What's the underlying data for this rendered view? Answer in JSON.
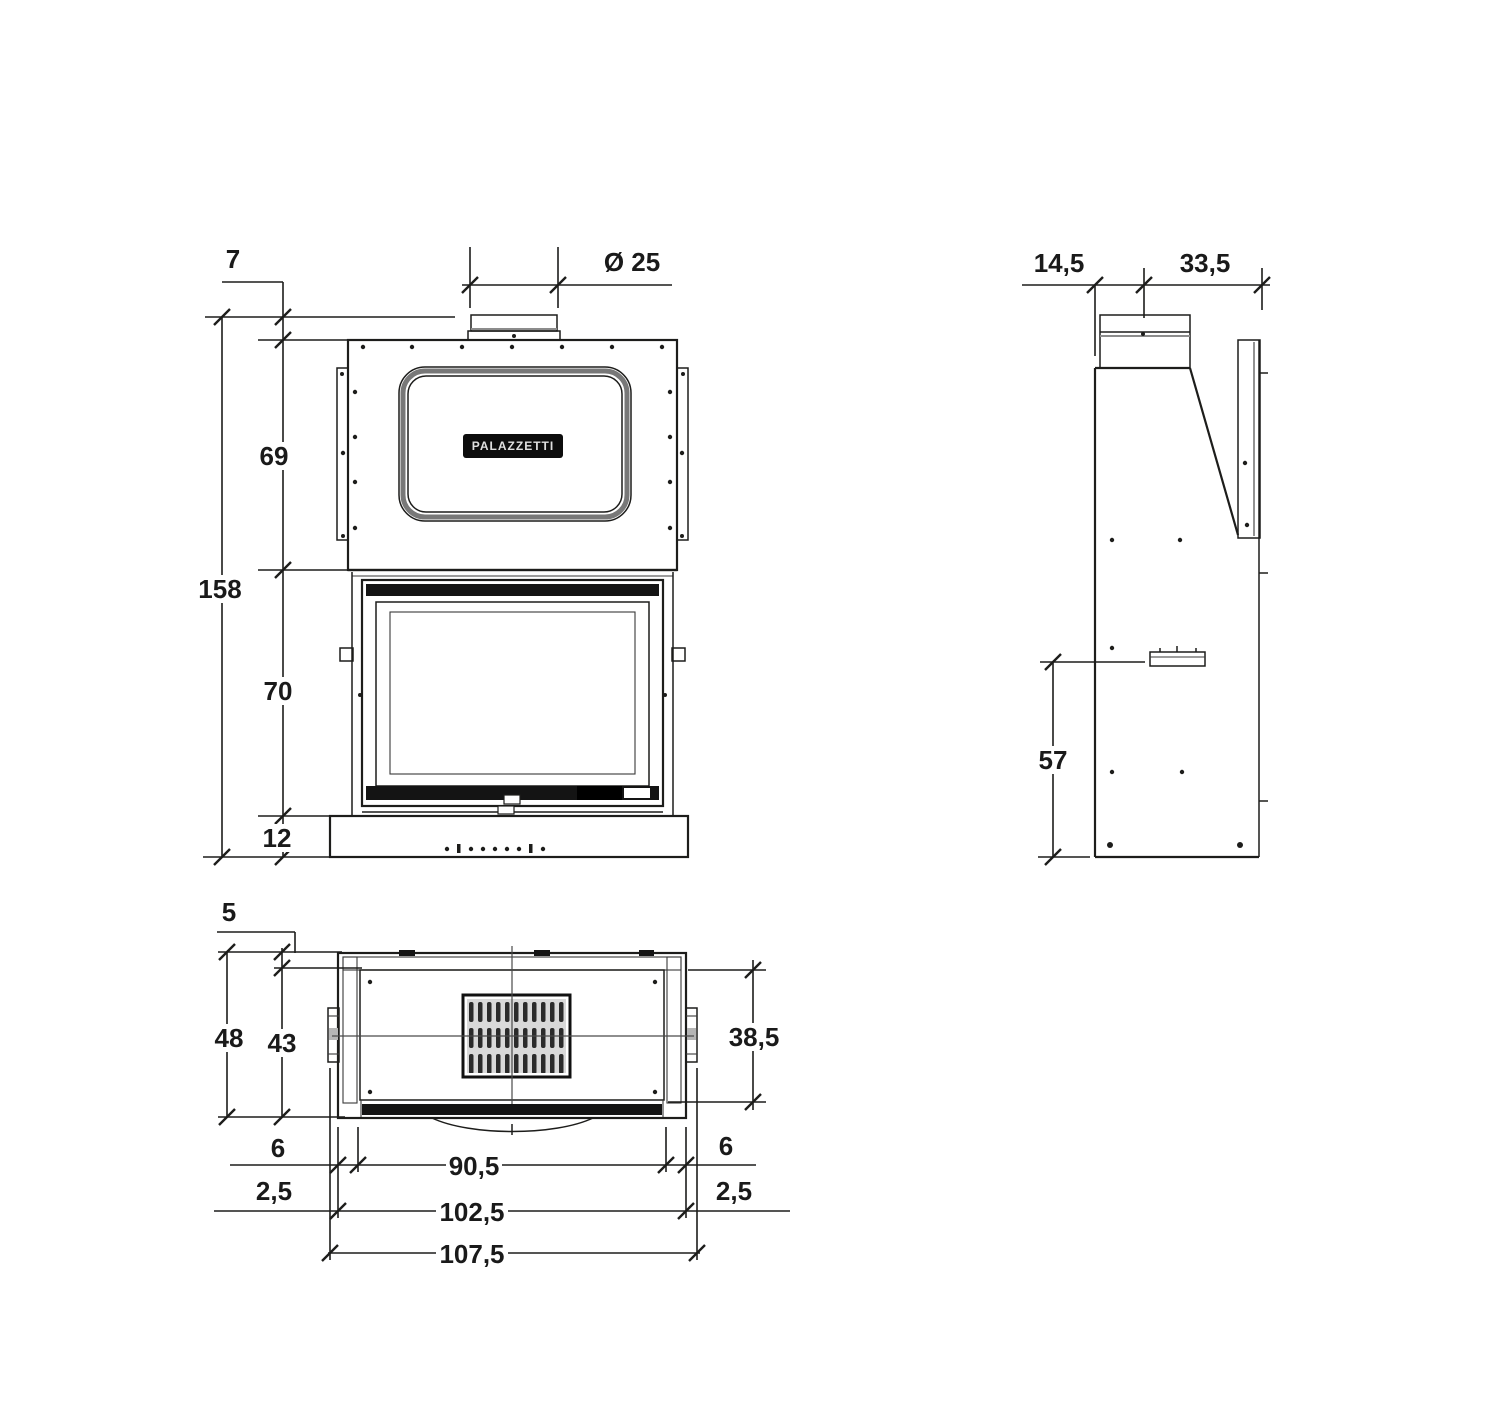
{
  "page": {
    "background": "#ffffff",
    "line_color": "#1d1d1b",
    "accent_dark_fill": "#141414"
  },
  "drawing": {
    "type": "technical-dimension-drawing",
    "views": {
      "front": {
        "name": "front-view",
        "logo_text": "PALAZZETTI",
        "dims": {
          "flue_collar_height": "7",
          "flue_diameter": "Ø 25",
          "hood_height": "69",
          "total_height": "158",
          "firebox_height": "70",
          "base_height": "12"
        }
      },
      "side": {
        "name": "side-view",
        "dims": {
          "front_to_flue_center": "14,5",
          "flue_center_to_back": "33,5",
          "outlet_height": "57"
        }
      },
      "plan": {
        "name": "plan-view",
        "dims": {
          "wall_thickness": "5",
          "total_depth": "48",
          "inner_depth": "43",
          "front_inner_depth": "38,5",
          "left_side": "6",
          "right_side": "6",
          "opening_width": "90,5",
          "left_edge": "2,5",
          "right_edge": "2,5",
          "body_width": "102,5",
          "total_width": "107,5"
        }
      }
    }
  }
}
